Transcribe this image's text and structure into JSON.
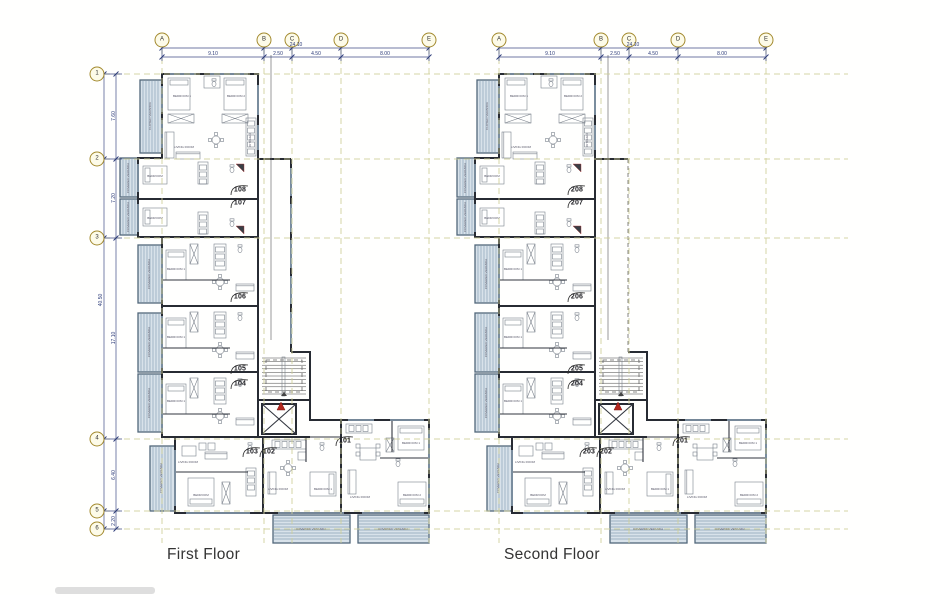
{
  "floors": [
    {
      "title": "First Floor",
      "units": [
        "108",
        "107",
        "106",
        "105",
        "104",
        "103",
        "102",
        "101"
      ]
    },
    {
      "title": "Second Floor",
      "units": [
        "208",
        "207",
        "206",
        "205",
        "204",
        "203",
        "202",
        "201"
      ]
    }
  ],
  "grid": {
    "columns": [
      "A",
      "B",
      "C",
      "D",
      "E"
    ],
    "rows": [
      "1",
      "2",
      "3",
      "4",
      "5",
      "6"
    ]
  },
  "dimensions": {
    "top_total": "24.10",
    "top_segments": [
      "9.10",
      "2.50",
      "4.50",
      "8.00"
    ],
    "left_total": "40.50",
    "left_segments": [
      "7.60",
      "7.20",
      "17.10",
      "6.40",
      "2.20"
    ]
  },
  "rooms": {
    "bedroom1": "BEDROOM 1",
    "bedroom2": "BEDROOM 2",
    "bedroom": "BEDROOM",
    "living": "LIVING ROOM",
    "kitchen": "KITCHEN",
    "closet": "CLOSET",
    "bathroom": "BATHROOM",
    "covered_veranda": "COVERED VERANDA",
    "closed_veranda": "CLOSED VERANDA"
  },
  "colors": {
    "wall": "#272b33",
    "grid_line": "#cfcf96",
    "dimension": "#2b3a78",
    "veranda_fill": "#d8e2ea",
    "veranda_stripe": "#8ba2b6",
    "fire_symbol": "#b3271f"
  }
}
